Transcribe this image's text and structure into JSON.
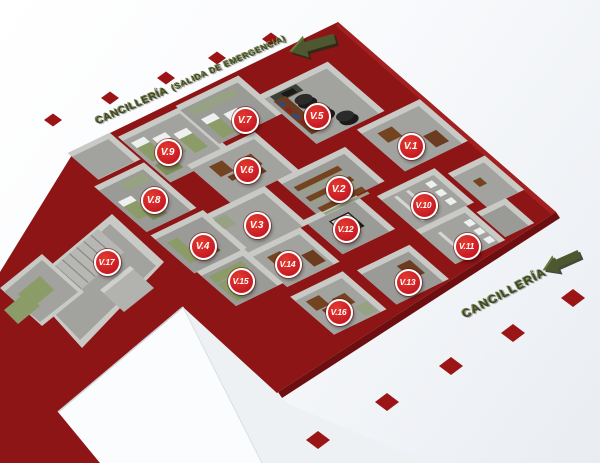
{
  "labels": {
    "top_exit": {
      "main": "CANCILLERÍA",
      "sub": "(SALIDA DE EMERGENCIA)"
    },
    "bottom_entrance": {
      "main": "CANCILLERÍA"
    }
  },
  "markers": [
    {
      "id": "v1",
      "label": "V.1",
      "x": 411,
      "y": 146
    },
    {
      "id": "v2",
      "label": "V.2",
      "x": 339,
      "y": 189
    },
    {
      "id": "v3",
      "label": "V.3",
      "x": 257,
      "y": 225
    },
    {
      "id": "v4",
      "label": "V.4",
      "x": 203,
      "y": 246
    },
    {
      "id": "v5",
      "label": "V.5",
      "x": 317,
      "y": 116
    },
    {
      "id": "v6",
      "label": "V.6",
      "x": 247,
      "y": 170
    },
    {
      "id": "v7",
      "label": "V.7",
      "x": 245,
      "y": 120
    },
    {
      "id": "v8",
      "label": "V.8",
      "x": 154,
      "y": 200
    },
    {
      "id": "v9",
      "label": "V.9",
      "x": 168,
      "y": 152
    },
    {
      "id": "v10",
      "label": "V.10",
      "x": 424,
      "y": 205
    },
    {
      "id": "v11",
      "label": "V.11",
      "x": 467,
      "y": 246
    },
    {
      "id": "v12",
      "label": "V.12",
      "x": 346,
      "y": 229
    },
    {
      "id": "v13",
      "label": "V.13",
      "x": 408,
      "y": 282
    },
    {
      "id": "v14",
      "label": "V.14",
      "x": 288,
      "y": 264
    },
    {
      "id": "v15",
      "label": "V.15",
      "x": 241,
      "y": 281
    },
    {
      "id": "v16",
      "label": "V.16",
      "x": 339,
      "y": 312
    },
    {
      "id": "v17",
      "label": "V.17",
      "x": 107,
      "y": 262
    }
  ],
  "arrows": [
    {
      "name": "exit-arrow-top",
      "x": 312,
      "y": 45,
      "angle": -16,
      "scale": 1.25
    },
    {
      "name": "entrance-arrow-bottom",
      "x": 561,
      "y": 262,
      "angle": -24,
      "scale": 1.05
    }
  ],
  "decor": {
    "diamonds_top": [
      [
        53,
        120
      ],
      [
        110,
        98
      ],
      [
        166,
        78
      ],
      [
        217,
        58
      ],
      [
        271,
        39
      ]
    ],
    "diamonds_bottom": [
      [
        318,
        440
      ],
      [
        387,
        402
      ],
      [
        451,
        366
      ],
      [
        513,
        333
      ],
      [
        573,
        298
      ]
    ],
    "diamond_top_size": [
      18,
      13
    ],
    "diamond_bottom_size": [
      24,
      18
    ]
  },
  "colors": {
    "slab_red": "#8e1516",
    "marker_red": "#cf2127",
    "marker_ring": "#ffffff",
    "diamond_red": "#9b1516",
    "arrow_olive": "#4d5730",
    "label_olive": "#3e4621",
    "room_floor": "#a2a29f",
    "room_wall": "#c9c9c6",
    "furniture_olive": "#8c9c68",
    "furniture_brown": "#74431f",
    "tire_black": "#1a1a1a",
    "bg_bottom": "#e9edf2"
  }
}
